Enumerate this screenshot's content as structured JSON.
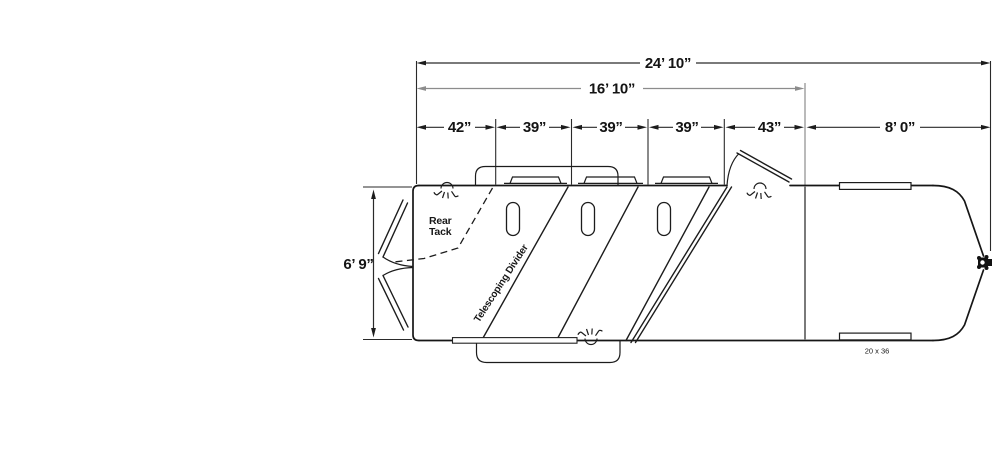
{
  "dimensions": {
    "overall_length": "24’ 10”",
    "horse_area_length": "16’ 10”",
    "rear_tack_width": "42”",
    "stall_1_width": "39”",
    "stall_2_width": "39”",
    "stall_3_width": "39”",
    "stall_4_width": "43”",
    "gooseneck_length": "8’ 0”",
    "box_width": "6’ 9”"
  },
  "labels": {
    "rear_tack_line_1": "Rear",
    "rear_tack_line_2": "Tack",
    "telescoping_divider": "Telescoping Divider",
    "window_size": "20 x 36"
  },
  "colors": {
    "line": "#161616",
    "secondary_line": "#8c8c8c",
    "background": "#ffffff"
  }
}
